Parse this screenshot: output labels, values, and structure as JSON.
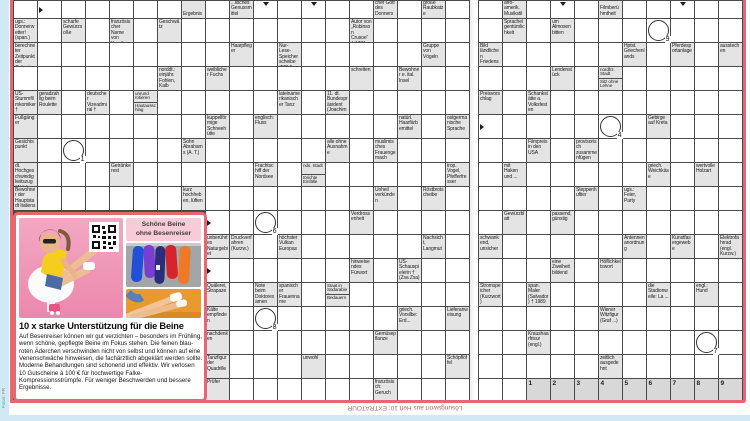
{
  "colors": {
    "frame_red": "#e5676f",
    "clue_cell_bg": "#e4e4e4",
    "grid_line": "#4a4a4a",
    "page_edge_blue": "#cfe9f5",
    "ad_badge_pink": "#f7ccd8",
    "footer_text": "#b5646b"
  },
  "footer": {
    "solution_note": "Lösungswort aus Heft 10: EXTRATOUR",
    "photo_credit": "Fotos: PR"
  },
  "ad": {
    "badge_line1": "Schöne Beine",
    "badge_line2": "ohne Besenreiser",
    "headline": "10 x starke Unterstützung für die Beine",
    "body": "Auf Besenreiser können wir gut verzichten – besonders im Frühling, wenn schöne, gepflegte Beine im Fokus stehen. Die feinen blau-roten Äderchen verschwinden nicht von selbst und können auf eine Venenschwäche hinweisen, die fachärztlich abgeklärt werden sollte. Moderne Behandlungen sind schonend und effektiv. Wir verlosen 10 Gutscheine à 100 € für hochwertige Falke-Kompressionsstrümpfe. Für weniger Beschwerden und bessere Ergebnisse.",
    "images": [
      "woman-on-chair-photo",
      "qr-code",
      "colorful-tights-photo",
      "bare-legs-photo"
    ]
  },
  "grid": {
    "rows": 17,
    "left_cols": 19,
    "right_cols": 11,
    "ad_hole": {
      "rows_from": 9,
      "cols_until": 7
    },
    "clues": [
      {
        "p": "L",
        "r": 0,
        "c": 7,
        "t": "Ergebnis",
        "a": "d"
      },
      {
        "p": "L",
        "r": 0,
        "c": 9,
        "t": "...lisches Genussmittel",
        "a": "r"
      },
      {
        "p": "L",
        "r": 0,
        "c": 15,
        "t": "germanischer Gott des Donners",
        "a": "d"
      },
      {
        "p": "L",
        "r": 0,
        "c": 17,
        "t": "große Raubkatze",
        "a": "r"
      },
      {
        "p": "L",
        "r": 1,
        "c": 0,
        "t": "ugs.: Donnerwetter! (span.)",
        "a": "r"
      },
      {
        "p": "L",
        "r": 1,
        "c": 2,
        "t": "scharfe Gewürzsoße",
        "a": "d"
      },
      {
        "p": "L",
        "r": 1,
        "c": 4,
        "t": "französischer Name von Korsika",
        "a": "d"
      },
      {
        "p": "L",
        "r": 1,
        "c": 6,
        "t": "Geschwätz",
        "a": "r"
      },
      {
        "p": "L",
        "r": 1,
        "c": 14,
        "t": "Autor von „Robinson Crusoe“ † 1731",
        "a": "r"
      },
      {
        "p": "L",
        "r": 2,
        "c": 0,
        "t": "berechneter Zeitpunkt der Geburt",
        "a": "r"
      },
      {
        "p": "L",
        "r": 2,
        "c": 9,
        "t": "Haarpfleger",
        "a": "d"
      },
      {
        "p": "L",
        "r": 2,
        "c": 11,
        "t": "Nur-Lese-Speicherscheibe (EDV)",
        "a": "r"
      },
      {
        "p": "L",
        "r": 2,
        "c": 17,
        "t": "Gruppe von Vögeln",
        "a": "d"
      },
      {
        "p": "L",
        "r": 3,
        "c": 6,
        "t": "norddt.: einjähr. Fohlen, Kalb",
        "a": "d"
      },
      {
        "p": "L",
        "r": 3,
        "c": 8,
        "t": "weiblicher Fuchs",
        "a": "r"
      },
      {
        "p": "L",
        "r": 3,
        "c": 14,
        "t": "schreiten",
        "a": "d"
      },
      {
        "p": "L",
        "r": 3,
        "c": 16,
        "t": "Bewohner e. ital. Insel",
        "a": "r"
      },
      {
        "p": "L",
        "r": 4,
        "c": 0,
        "t": "US-Stummfilmkomiker †",
        "a": "r"
      },
      {
        "p": "L",
        "r": 4,
        "c": 1,
        "t": "geradzahlig beim Roulette",
        "a": "d"
      },
      {
        "p": "L",
        "r": 4,
        "c": 3,
        "t": "deutscher Vizeadmiral †",
        "a": "d"
      },
      {
        "p": "L",
        "r": 4,
        "c": 5,
        "t": "unrund rotieren",
        "a": "r",
        "t2": "Hautausschlag",
        "a2": "d"
      },
      {
        "p": "L",
        "r": 4,
        "c": 11,
        "t": "lateinamerikanischer Tanz",
        "a": "d"
      },
      {
        "p": "L",
        "r": 4,
        "c": 13,
        "t": "11. dt. Bundespräsident (Joachim)",
        "a": "r"
      },
      {
        "p": "L",
        "r": 5,
        "c": 0,
        "t": "Fußgänger",
        "a": "r"
      },
      {
        "p": "L",
        "r": 5,
        "c": 8,
        "t": "kuppelförmige Schneehütte",
        "a": "d"
      },
      {
        "p": "L",
        "r": 5,
        "c": 10,
        "t": "englisch: Fluss",
        "a": "r"
      },
      {
        "p": "L",
        "r": 5,
        "c": 16,
        "t": "natürl. Haarfärbemittel",
        "a": "d"
      },
      {
        "p": "L",
        "r": 5,
        "c": 18,
        "t": "ostgermanische Sprache",
        "a": "r"
      },
      {
        "p": "L",
        "r": 6,
        "c": 0,
        "t": "Gesichtspunkt",
        "a": "r"
      },
      {
        "p": "L",
        "r": 6,
        "c": 7,
        "t": "Sohn Abrahams (A. T.)",
        "a": "r"
      },
      {
        "p": "L",
        "r": 6,
        "c": 13,
        "t": "alle ohne Ausnahme",
        "a": "d"
      },
      {
        "p": "L",
        "r": 6,
        "c": 15,
        "t": "muslimisches Frauengemach",
        "a": "r"
      },
      {
        "p": "L",
        "r": 7,
        "c": 0,
        "t": "dt. Hochgeschwindigkeitszug (Abk.)",
        "a": "r"
      },
      {
        "p": "L",
        "r": 7,
        "c": 4,
        "t": "Getränkerest",
        "a": "r"
      },
      {
        "p": "L",
        "r": 7,
        "c": 10,
        "t": "Frachtschiff der Nordsee",
        "a": "d"
      },
      {
        "p": "L",
        "r": 7,
        "c": 12,
        "t": "nds. Stadt",
        "a": "r",
        "t2": "törichte Einfälle",
        "a2": "r"
      },
      {
        "p": "L",
        "r": 7,
        "c": 18,
        "t": "trop. Vogel, Pfefferfresser",
        "a": "d"
      },
      {
        "p": "L",
        "r": 8,
        "c": 0,
        "t": "Bewohner der Hauptstadt Italiens",
        "a": "r"
      },
      {
        "p": "L",
        "r": 8,
        "c": 7,
        "t": "kurz hochheben, lüften",
        "a": "r"
      },
      {
        "p": "L",
        "r": 8,
        "c": 15,
        "t": "Unheil verkünden",
        "a": "r"
      },
      {
        "p": "L",
        "r": 8,
        "c": 17,
        "t": "Röstbrotscheibe",
        "a": "r"
      },
      {
        "p": "L",
        "r": 9,
        "c": 14,
        "t": "Verdrossenheit",
        "a": "r"
      },
      {
        "p": "L",
        "r": 10,
        "c": 8,
        "t": "unberührtes Naturgebiet"
      },
      {
        "p": "L",
        "r": 10,
        "c": 9,
        "t": "Druckverfahren (Kurzw.)",
        "a": "d"
      },
      {
        "p": "L",
        "r": 10,
        "c": 11,
        "t": "höchster Vulkan Europas",
        "a": "r"
      },
      {
        "p": "L",
        "r": 10,
        "c": 17,
        "t": "Nachsicht, Langmut",
        "a": "d"
      },
      {
        "p": "L",
        "r": 11,
        "c": 14,
        "t": "hinweisendes Fürwort",
        "a": "d"
      },
      {
        "p": "L",
        "r": 11,
        "c": 16,
        "t": "US-Schauspielerin † (Zsa Zsa)",
        "a": "r"
      },
      {
        "p": "L",
        "r": 12,
        "c": 8,
        "t": "Quälerei, Strapaze",
        "a": "r"
      },
      {
        "p": "L",
        "r": 12,
        "c": 10,
        "t": "Note beim Doktorexamen",
        "a": "d"
      },
      {
        "p": "L",
        "r": 12,
        "c": 11,
        "t": "spanischer Frauenname",
        "a": "d"
      },
      {
        "p": "L",
        "r": 12,
        "c": 13,
        "t": "Staat in Südarabien",
        "a": "r",
        "t2": "Bedauern",
        "a2": "d"
      },
      {
        "p": "L",
        "r": 13,
        "c": 8,
        "t": "Kälte empfinden",
        "a": "r"
      },
      {
        "p": "L",
        "r": 13,
        "c": 16,
        "t": "griech. Vorsilbe: Erd...",
        "a": "d"
      },
      {
        "p": "L",
        "r": 13,
        "c": 18,
        "t": "Lieferanweisung"
      },
      {
        "p": "L",
        "r": 14,
        "c": 8,
        "t": "nachdenken",
        "a": "r"
      },
      {
        "p": "L",
        "r": 14,
        "c": 15,
        "t": "Gemüsepflanze",
        "a": "r"
      },
      {
        "p": "L",
        "r": 15,
        "c": 8,
        "t": "Tanzfigur der Quadrille",
        "a": "r"
      },
      {
        "p": "L",
        "r": 15,
        "c": 12,
        "t": "unwohl",
        "a": "r"
      },
      {
        "p": "L",
        "r": 15,
        "c": 18,
        "t": "Schöpflöffel"
      },
      {
        "p": "L",
        "r": 16,
        "c": 8,
        "t": "Prüfer",
        "a": "r"
      },
      {
        "p": "L",
        "r": 16,
        "c": 15,
        "t": "französisch: Geruch",
        "a": "r"
      },
      {
        "p": "R",
        "r": 0,
        "c": 1,
        "t": "afro-amerik. Musikstil",
        "a": "r"
      },
      {
        "p": "R",
        "r": 0,
        "c": 5,
        "t": "Filmberühmtheit",
        "a": "r"
      },
      {
        "p": "R",
        "r": 1,
        "c": 1,
        "t": "Spracheigentümlichkeit",
        "a": "d"
      },
      {
        "p": "R",
        "r": 1,
        "c": 3,
        "t": "um Almosen bitten",
        "a": "r"
      },
      {
        "p": "R",
        "r": 2,
        "c": 0,
        "t": "Bild ländlichen Friedens",
        "a": "r"
      },
      {
        "p": "R",
        "r": 2,
        "c": 6,
        "t": "Hptst. Griechenlands",
        "a": "d"
      },
      {
        "p": "R",
        "r": 2,
        "c": 8,
        "t": "Pferdesportanlage",
        "a": "d"
      },
      {
        "p": "R",
        "r": 2,
        "c": 10,
        "t": "ausstechen",
        "a": "d"
      },
      {
        "p": "R",
        "r": 3,
        "c": 3,
        "t": "Lendenstück",
        "a": "d"
      },
      {
        "p": "R",
        "r": 3,
        "c": 5,
        "t": "nordfrz. Stadt",
        "a": "r",
        "t2": "Sitz ohne Lehne",
        "a2": "d"
      },
      {
        "p": "R",
        "r": 4,
        "c": 0,
        "t": "Preisvorschlag",
        "a": "d"
      },
      {
        "p": "R",
        "r": 4,
        "c": 2,
        "t": "Schankstätte a. Volksfesten",
        "a": "r"
      },
      {
        "p": "R",
        "r": 5,
        "c": 7,
        "t": "Gebirge auf Kreta",
        "a": "r"
      },
      {
        "p": "R",
        "r": 6,
        "c": 2,
        "t": "Filmpreis in den USA",
        "a": "d"
      },
      {
        "p": "R",
        "r": 6,
        "c": 4,
        "t": "provisorisch zusammenfügen",
        "a": "r"
      },
      {
        "p": "R",
        "r": 7,
        "c": 1,
        "t": "mit Haken und ...",
        "a": "r"
      },
      {
        "p": "R",
        "r": 7,
        "c": 7,
        "t": "griech. Weichkäse",
        "a": "d"
      },
      {
        "p": "R",
        "r": 7,
        "c": 9,
        "t": "wertvolle Holzart",
        "a": "d"
      },
      {
        "p": "R",
        "r": 8,
        "c": 4,
        "t": "Steppenhuftier",
        "a": "d"
      },
      {
        "p": "R",
        "r": 8,
        "c": 6,
        "t": "ugs.: Feier, Party",
        "a": "r"
      },
      {
        "p": "R",
        "r": 9,
        "c": 1,
        "t": "Gewürzblatt",
        "a": "d"
      },
      {
        "p": "R",
        "r": 9,
        "c": 3,
        "t": "passend, günstig",
        "a": "r"
      },
      {
        "p": "R",
        "r": 10,
        "c": 0,
        "t": "schwankend, unsicher",
        "a": "r"
      },
      {
        "p": "R",
        "r": 10,
        "c": 6,
        "t": "Antennenanordnung",
        "a": "d"
      },
      {
        "p": "R",
        "r": 10,
        "c": 8,
        "t": "Kunstfasergewebe",
        "a": "d"
      },
      {
        "p": "R",
        "r": 10,
        "c": 10,
        "t": "Elektrofahrrad (engl. Kurzw.)",
        "a": "d"
      },
      {
        "p": "R",
        "r": 11,
        "c": 3,
        "t": "eine Zweiheit bildend",
        "a": "d"
      },
      {
        "p": "R",
        "r": 11,
        "c": 5,
        "t": "Höflichkeitswort",
        "a": "r"
      },
      {
        "p": "R",
        "r": 12,
        "c": 0,
        "t": "Stromspeicher (Kurzwort)",
        "a": "d"
      },
      {
        "p": "R",
        "r": 12,
        "c": 2,
        "t": "span. Maler (Salvador) † 1989",
        "a": "r"
      },
      {
        "p": "R",
        "r": 12,
        "c": 7,
        "t": "die Stadionwelle: La ...",
        "a": "d"
      },
      {
        "p": "R",
        "r": 12,
        "c": 9,
        "t": "engl.: Hund",
        "a": "d"
      },
      {
        "p": "R",
        "r": 13,
        "c": 5,
        "t": "Wiener Witzfigur (Graf ...)",
        "a": "r"
      },
      {
        "p": "R",
        "r": 14,
        "c": 2,
        "t": "Kraushaarfrisur (engl.)",
        "a": "r"
      },
      {
        "p": "R",
        "r": 15,
        "c": 5,
        "t": "zeitlich ausgedehnt",
        "a": "r"
      }
    ],
    "circles": [
      {
        "p": "L",
        "r": 6,
        "c": 2,
        "n": "1"
      },
      {
        "p": "R",
        "r": 5,
        "c": 5,
        "n": "4"
      },
      {
        "p": "L",
        "r": 9,
        "c": 10,
        "n": "6"
      },
      {
        "p": "R",
        "r": 14,
        "c": 9,
        "n": "7"
      },
      {
        "p": "L",
        "r": 13,
        "c": 10,
        "n": "8"
      },
      {
        "p": "R",
        "r": 1,
        "c": 7,
        "n": "9"
      }
    ],
    "free_arrows": [
      {
        "p": "L",
        "r": 0,
        "c": 1,
        "k": "r"
      },
      {
        "p": "L",
        "r": 0,
        "c": 10,
        "k": "d"
      },
      {
        "p": "L",
        "r": 0,
        "c": 12,
        "k": "d"
      },
      {
        "p": "R",
        "r": 0,
        "c": 3,
        "k": "d"
      },
      {
        "p": "R",
        "r": 0,
        "c": 8,
        "k": "d"
      },
      {
        "p": "L",
        "r": 9,
        "c": 8,
        "k": "r"
      },
      {
        "p": "L",
        "r": 11,
        "c": 8,
        "k": "r"
      },
      {
        "p": "R",
        "r": 5,
        "c": 0,
        "k": "r"
      }
    ],
    "solution_cells": [
      {
        "p": "R",
        "r": 16,
        "c": 2,
        "n": "1"
      },
      {
        "p": "R",
        "r": 16,
        "c": 3,
        "n": "2"
      },
      {
        "p": "R",
        "r": 16,
        "c": 4,
        "n": "3"
      },
      {
        "p": "R",
        "r": 16,
        "c": 5,
        "n": "4"
      },
      {
        "p": "R",
        "r": 16,
        "c": 6,
        "n": "5"
      },
      {
        "p": "R",
        "r": 16,
        "c": 7,
        "n": "6"
      },
      {
        "p": "R",
        "r": 16,
        "c": 8,
        "n": "7"
      },
      {
        "p": "R",
        "r": 16,
        "c": 9,
        "n": "8"
      },
      {
        "p": "R",
        "r": 16,
        "c": 10,
        "n": "9"
      }
    ]
  }
}
